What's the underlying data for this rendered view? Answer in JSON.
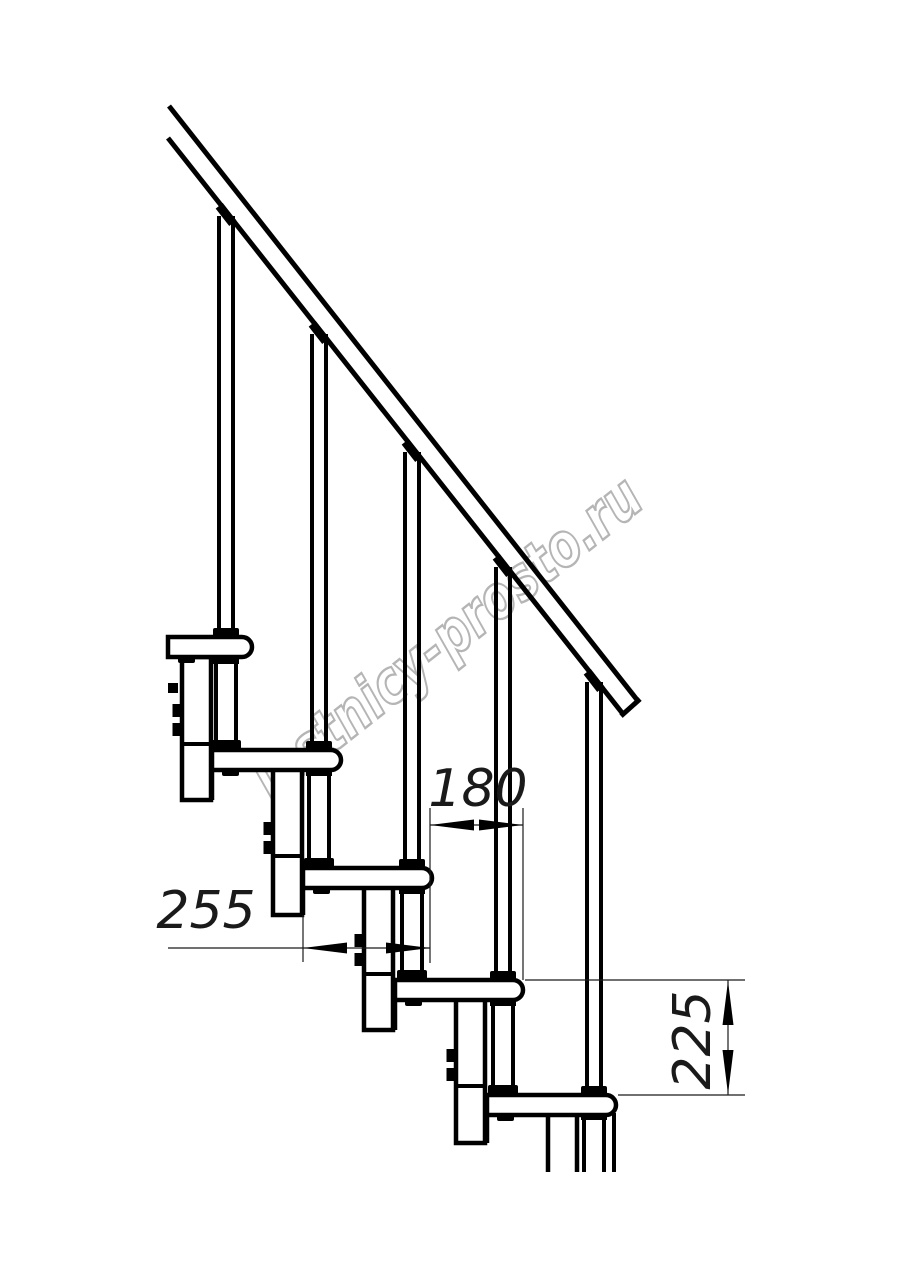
{
  "watermark": {
    "text": "lestnicy-prosto.ru",
    "color": "#b5b5b5"
  },
  "dimensions": {
    "tread_length": {
      "value": "255"
    },
    "going": {
      "value": "180"
    },
    "rise": {
      "value": "225"
    }
  },
  "drawing": {
    "line_color": "#000000",
    "background": "#ffffff",
    "treads_visible": 5,
    "balusters_visible": 5
  }
}
